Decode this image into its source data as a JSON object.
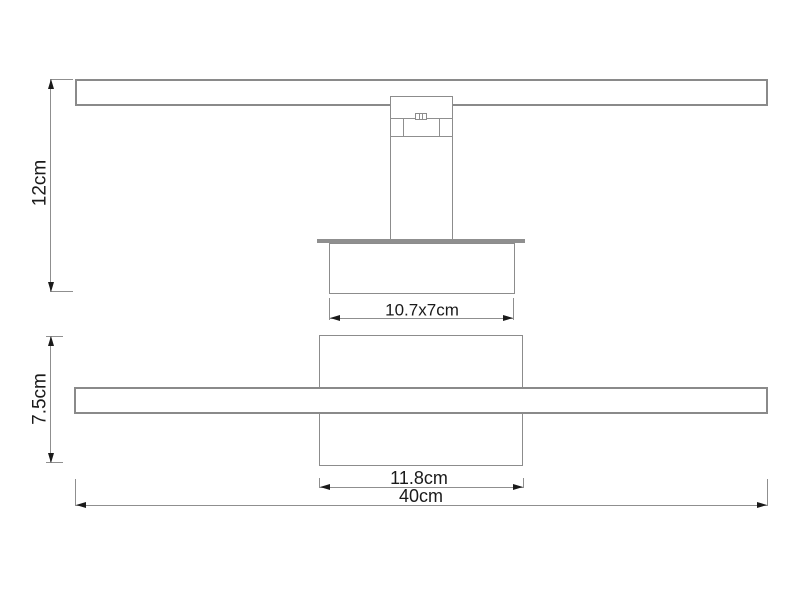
{
  "diagram": {
    "side_view": {
      "height_label": "12cm",
      "mount_size_label": "10.7x7cm"
    },
    "front_view": {
      "height_label": "7.5cm",
      "backplate_width_label": "11.8cm",
      "total_width_label": "40cm"
    },
    "colors": {
      "line": "#8f8f8f",
      "arrow": "#1a1a1a",
      "text": "#1a1a1a",
      "background": "#ffffff"
    }
  }
}
